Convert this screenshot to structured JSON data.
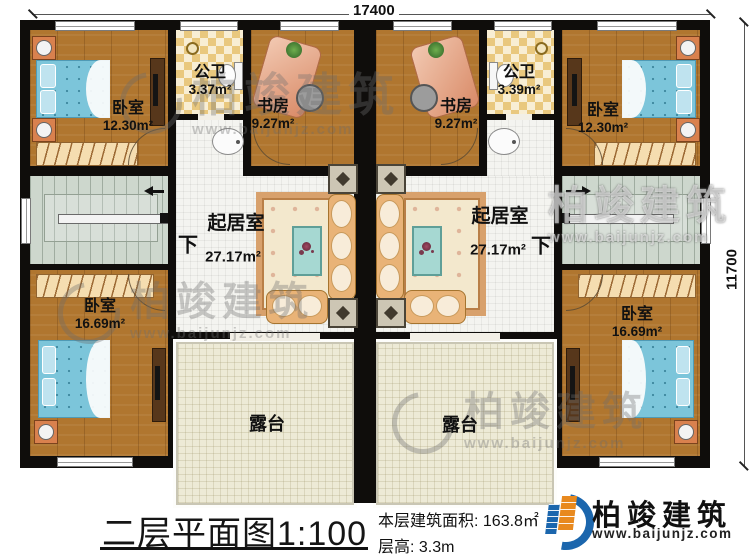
{
  "plan": {
    "dim_top": "17400",
    "dim_right": "11700",
    "down": "下",
    "rooms": {
      "bedroom_tl": {
        "name": "卧室",
        "area": "12.30m²"
      },
      "bath_l": {
        "name": "公卫",
        "area": "3.37m²"
      },
      "study_l": {
        "name": "书房",
        "area": "9.27m²"
      },
      "study_r": {
        "name": "书房",
        "area": "9.27m²"
      },
      "bath_r": {
        "name": "公卫",
        "area": "3.39m²"
      },
      "bedroom_tr": {
        "name": "卧室",
        "area": "12.30m²"
      },
      "living_l": {
        "name": "起居室",
        "area": "27.17m²"
      },
      "living_r": {
        "name": "起居室",
        "area": "27.17m²"
      },
      "bedroom_bl": {
        "name": "卧室",
        "area": "16.69m²"
      },
      "bedroom_br": {
        "name": "卧室",
        "area": "16.69m²"
      },
      "terrace_l": {
        "name": "露台"
      },
      "terrace_r": {
        "name": "露台"
      }
    }
  },
  "title_block": {
    "title": "二层平面图",
    "scale": "1:100",
    "area_label": "本层建筑面积: 163.8㎡",
    "floor_height_label": "层高: 3.3m"
  },
  "brand": {
    "name": "柏竣建筑",
    "website": "www.baijunjz.com"
  },
  "watermark": {
    "name": "柏竣建筑",
    "website": "www.baijunjz.com"
  },
  "colors": {
    "wall": "#0f0d0b",
    "wood": "#b0762f",
    "tile": "#f4f4f0",
    "terrace": "#edead6",
    "stairs": "#cdd7cd",
    "bed": "#7cc5da",
    "brand_blue": "#1b66ad",
    "brand_orange": "#e8891e"
  }
}
